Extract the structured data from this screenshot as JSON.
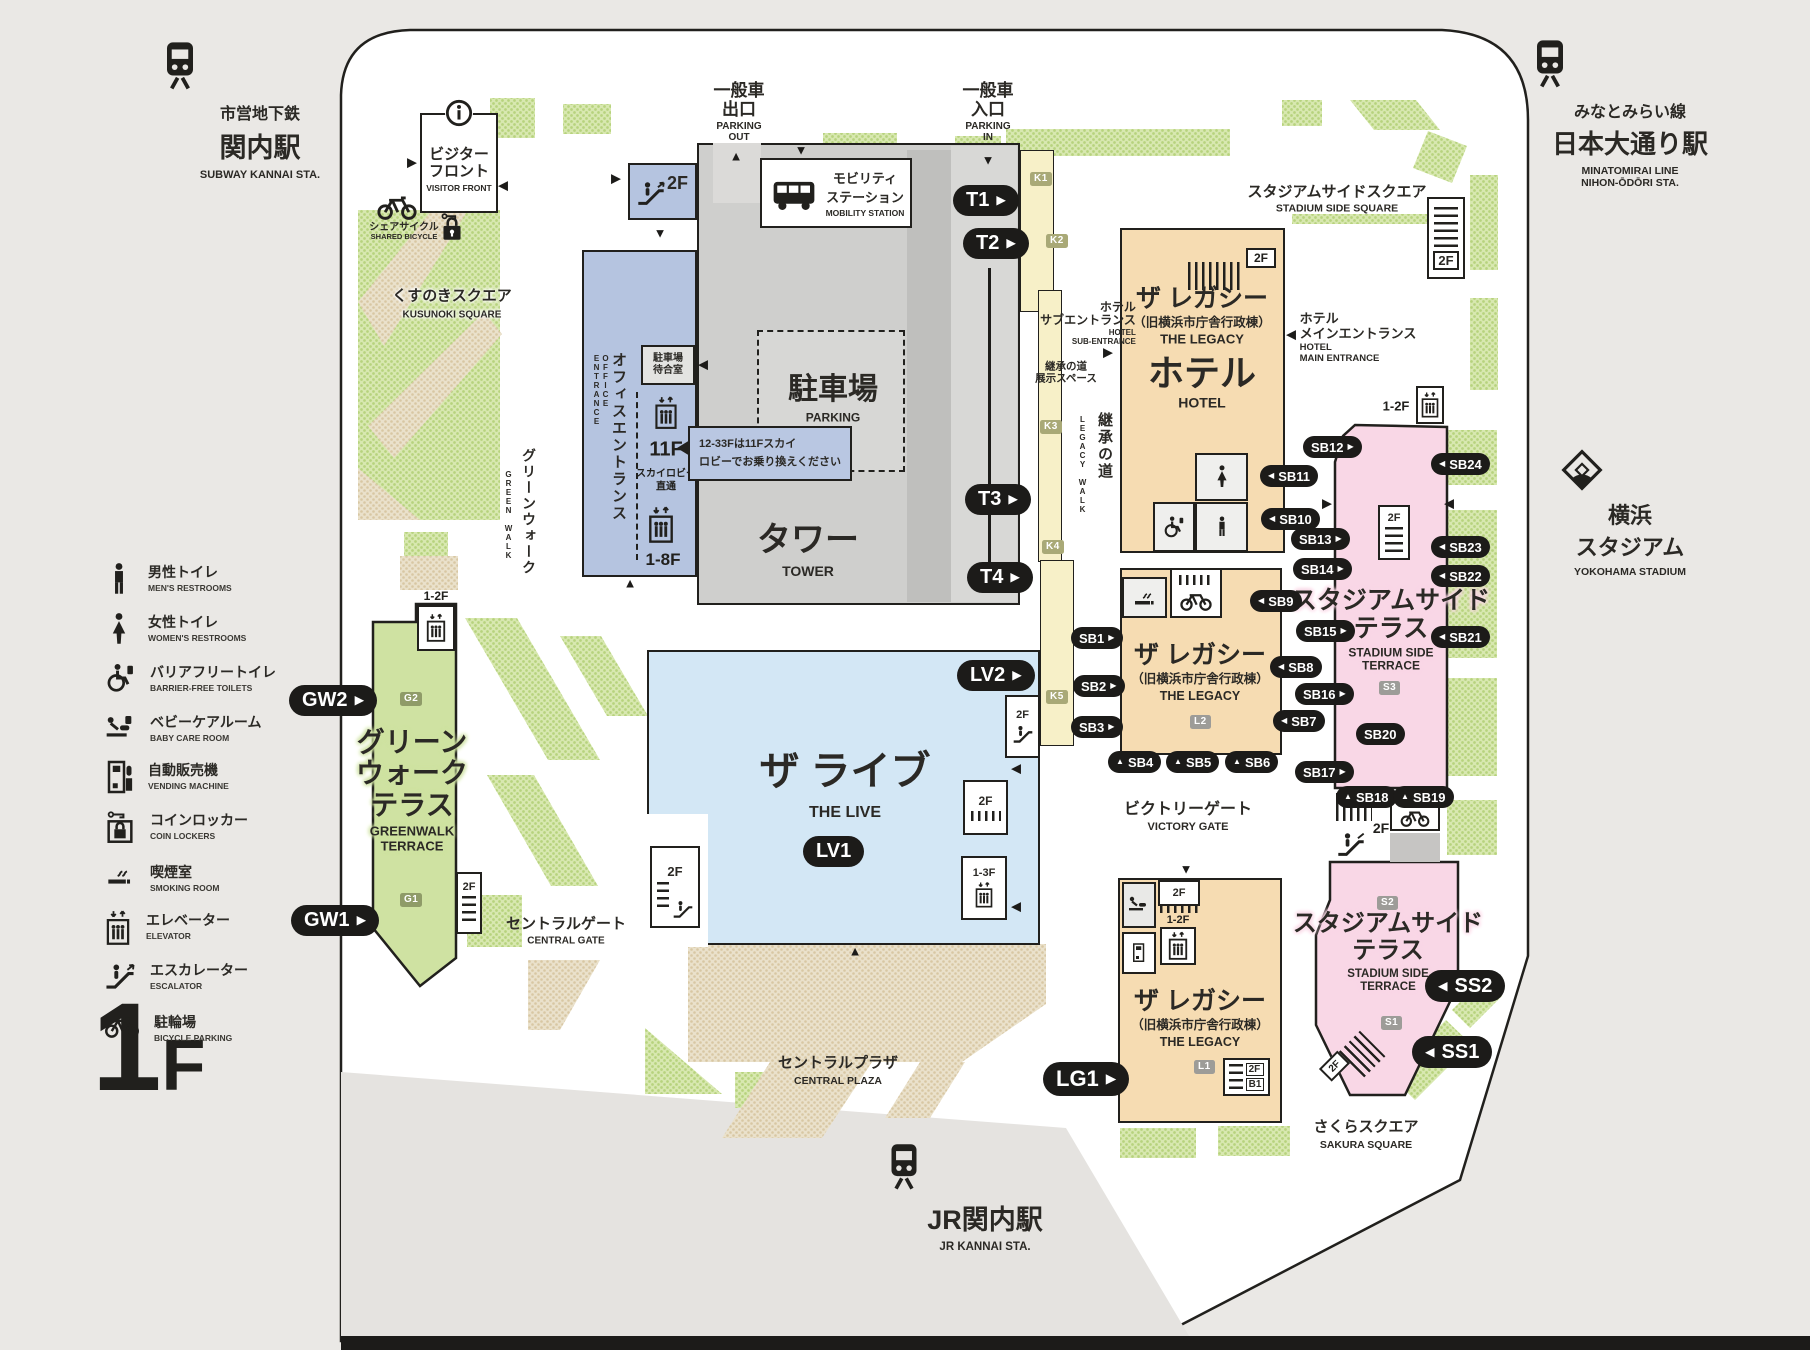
{
  "glyphs": {
    "up": "▲",
    "down": "▼",
    "left": "◀",
    "right": "▶"
  },
  "stations": {
    "subway": {
      "line": "市営地下鉄",
      "name": "関内駅",
      "en": "SUBWAY KANNAI STA."
    },
    "minatomirai": {
      "line": "みなとみらい線",
      "name": "日本大通り駅",
      "en_line": "MINATOMIRAI LINE",
      "en_sta": "NIHON-ŌDŌRI STA."
    },
    "jr": {
      "name": "JR関内駅",
      "en": "JR KANNAI STA."
    },
    "stadium": {
      "jp1": "横浜",
      "jp2": "スタジアム",
      "en": "YOKOHAMA STADIUM"
    }
  },
  "floor_label": {
    "number": "1",
    "suffix": "F"
  },
  "floors": {
    "f2": "2F",
    "f1_2": "1-2F",
    "f1_3": "1-3F",
    "f1_8": "1-8F",
    "f11": "11F",
    "b1": "B1"
  },
  "legend": {
    "items": [
      {
        "jp": "男性トイレ",
        "en": "MEN'S RESTROOMS"
      },
      {
        "jp": "女性トイレ",
        "en": "WOMEN'S RESTROOMS"
      },
      {
        "jp": "バリアフリートイレ",
        "en": "BARRIER-FREE TOILETS"
      },
      {
        "jp": "ベビーケアルーム",
        "en": "BABY CARE ROOM"
      },
      {
        "jp": "自動販売機",
        "en": "VENDING MACHINE"
      },
      {
        "jp": "コインロッカー",
        "en": "COIN LOCKERS"
      },
      {
        "jp": "喫煙室",
        "en": "SMOKING ROOM"
      },
      {
        "jp": "エレベーター",
        "en": "ELEVATOR"
      },
      {
        "jp": "エスカレーター",
        "en": "ESCALATOR"
      },
      {
        "jp": "駐輪場",
        "en": "BICYCLE PARKING"
      }
    ]
  },
  "poi": {
    "visitor_front": {
      "jp1": "ビジター",
      "jp2": "フロント",
      "en": "VISITOR FRONT"
    },
    "shared_bicycle": {
      "jp": "シェアサイクル",
      "en": "SHARED BICYCLE"
    },
    "kusunoki": {
      "jp": "くすのきスクエア",
      "en": "KUSUNOKI SQUARE"
    },
    "green_walk": {
      "jp": "グリーンウォーク",
      "en": "GREEN WALK"
    },
    "office_entrance": {
      "jp": "オフィスエントランス",
      "en": "OFFICE ENTRANCE"
    },
    "parking_wait": {
      "jp1": "駐車場",
      "jp2": "待合室"
    },
    "sky_lobby": {
      "jp1": "スカイロビー",
      "jp2": "直通"
    },
    "sky_note": {
      "line1": "12-33Fは11Fスカイ",
      "line2": "ロビーでお乗り換えください"
    },
    "parking_out": {
      "jp1": "一般車",
      "jp2": "出口",
      "en1": "PARKING",
      "en2": "OUT"
    },
    "parking_in": {
      "jp1": "一般車",
      "jp2": "入口",
      "en1": "PARKING",
      "en2": "IN"
    },
    "mobility": {
      "jp1": "モビリティ",
      "jp2": "ステーション",
      "en": "MOBILITY STATION"
    },
    "parking": {
      "jp": "駐車場",
      "en": "PARKING"
    },
    "tower": {
      "jp": "タワー",
      "en": "TOWER"
    },
    "stadium_square": {
      "jp": "スタジアムサイドスクエア",
      "en": "STADIUM SIDE SQUARE"
    },
    "hotel_sub": {
      "jp1": "ホテル",
      "jp2": "サブエントランス",
      "en1": "HOTEL",
      "en2": "SUB-ENTRANCE"
    },
    "legacy_exhibit": {
      "jp1": "継承の道",
      "jp2": "展示スペース"
    },
    "legacy_walk": {
      "jp": "継承の道",
      "en": "LEGACY WALK"
    },
    "hotel_main": {
      "jp1": "ホテル",
      "jp2": "メインエントランス",
      "en1": "HOTEL",
      "en2": "MAIN ENTRANCE"
    },
    "legacy_hotel": {
      "t1": "ザ レガシー",
      "t2": "（旧横浜市庁舎行政棟）",
      "t3": "THE LEGACY",
      "t4": "ホテル",
      "t5": "HOTEL"
    },
    "legacy_mid": {
      "t1": "ザ レガシー",
      "t2": "（旧横浜市庁舎行政棟）",
      "t3": "THE LEGACY"
    },
    "legacy_south": {
      "t1": "ザ レガシー",
      "t2": "（旧横浜市庁舎行政棟）",
      "t3": "THE LEGACY"
    },
    "victory_gate": {
      "jp": "ビクトリーゲート",
      "en": "VICTORY GATE"
    },
    "terrace_n": {
      "jp1": "スタジアムサイド",
      "jp2": "テラス",
      "en1": "STADIUM SIDE",
      "en2": "TERRACE"
    },
    "terrace_s": {
      "jp1": "スタジアムサイド",
      "jp2": "テラス",
      "en1": "STADIUM SIDE",
      "en2": "TERRACE"
    },
    "sakura": {
      "jp": "さくらスクエア",
      "en": "SAKURA SQUARE"
    },
    "the_live": {
      "jp": "ザ ライブ",
      "en": "THE LIVE"
    },
    "central_gate": {
      "jp": "セントラルゲート",
      "en": "CENTRAL GATE"
    },
    "central_plaza": {
      "jp": "セントラルプラザ",
      "en": "CENTRAL PLAZA"
    },
    "greenwalk_terrace": {
      "jp1": "グリーン",
      "jp2": "ウォーク",
      "jp3": "テラス",
      "en1": "GREENWALK",
      "en2": "TERRACE"
    }
  },
  "pills": {
    "t1": {
      "label": "T1",
      "arrow": "▶"
    },
    "t2": {
      "label": "T2",
      "arrow": "▶"
    },
    "t3": {
      "label": "T3",
      "arrow": "▶"
    },
    "t4": {
      "label": "T4",
      "arrow": "▶"
    },
    "lv1": {
      "label": "LV1",
      "arrow": ""
    },
    "lv2": {
      "label": "LV2",
      "arrow": "▶"
    },
    "lg1": {
      "label": "LG1",
      "arrow": "▶"
    },
    "gw1": {
      "label": "GW1",
      "arrow": "▶"
    },
    "gw2": {
      "label": "GW2",
      "arrow": "▶"
    },
    "ss1": {
      "label": "SS1",
      "arrow": "◀"
    },
    "ss2": {
      "label": "SS2",
      "arrow": "◀"
    },
    "sb1": {
      "label": "SB1",
      "arrow": "▶"
    },
    "sb2": {
      "label": "SB2",
      "arrow": "▶"
    },
    "sb3": {
      "label": "SB3",
      "arrow": "▶"
    },
    "sb4": {
      "label": "SB4",
      "arrow": "▲"
    },
    "sb5": {
      "label": "SB5",
      "arrow": "▲"
    },
    "sb6": {
      "label": "SB6",
      "arrow": "▲"
    },
    "sb7": {
      "label": "SB7",
      "arrow": "◀"
    },
    "sb8": {
      "label": "SB8",
      "arrow": "◀"
    },
    "sb9": {
      "label": "SB9",
      "arrow": "◀"
    },
    "sb10": {
      "label": "SB10",
      "arrow": "◀"
    },
    "sb11": {
      "label": "SB11",
      "arrow": "◀"
    },
    "sb12": {
      "label": "SB12",
      "arrow": "▶"
    },
    "sb13": {
      "label": "SB13",
      "arrow": "▶"
    },
    "sb14": {
      "label": "SB14",
      "arrow": "▶"
    },
    "sb15": {
      "label": "SB15",
      "arrow": "▶"
    },
    "sb16": {
      "label": "SB16",
      "arrow": "▶"
    },
    "sb17": {
      "label": "SB17",
      "arrow": "▶"
    },
    "sb18": {
      "label": "SB18",
      "arrow": "▲"
    },
    "sb19": {
      "label": "SB19",
      "arrow": "▲"
    },
    "sb20": {
      "label": "SB20",
      "arrow": ""
    },
    "sb21": {
      "label": "SB21",
      "arrow": "◀"
    },
    "sb22": {
      "label": "SB22",
      "arrow": "◀"
    },
    "sb23": {
      "label": "SB23",
      "arrow": "◀"
    },
    "sb24": {
      "label": "SB24",
      "arrow": "◀"
    }
  },
  "badges": {
    "k1": "K1",
    "k2": "K2",
    "k3": "K3",
    "k4": "K4",
    "k5": "K5",
    "g1": "G1",
    "g2": "G2",
    "l1": "L1",
    "l2": "L2",
    "s1": "S1",
    "s2": "S2",
    "s3": "S3"
  },
  "colors": {
    "pill": "#1c1b19",
    "office": "#b5c4e0",
    "live": "#d3e7f5",
    "legacy": "#f6dcb2",
    "terrace_pink": "#f9d7e6",
    "terrace_green": "#cfe2a2",
    "walk_yellow": "#f7f0c8",
    "green_dots": "#cbe097",
    "gray_building": "#cfcfcd"
  }
}
